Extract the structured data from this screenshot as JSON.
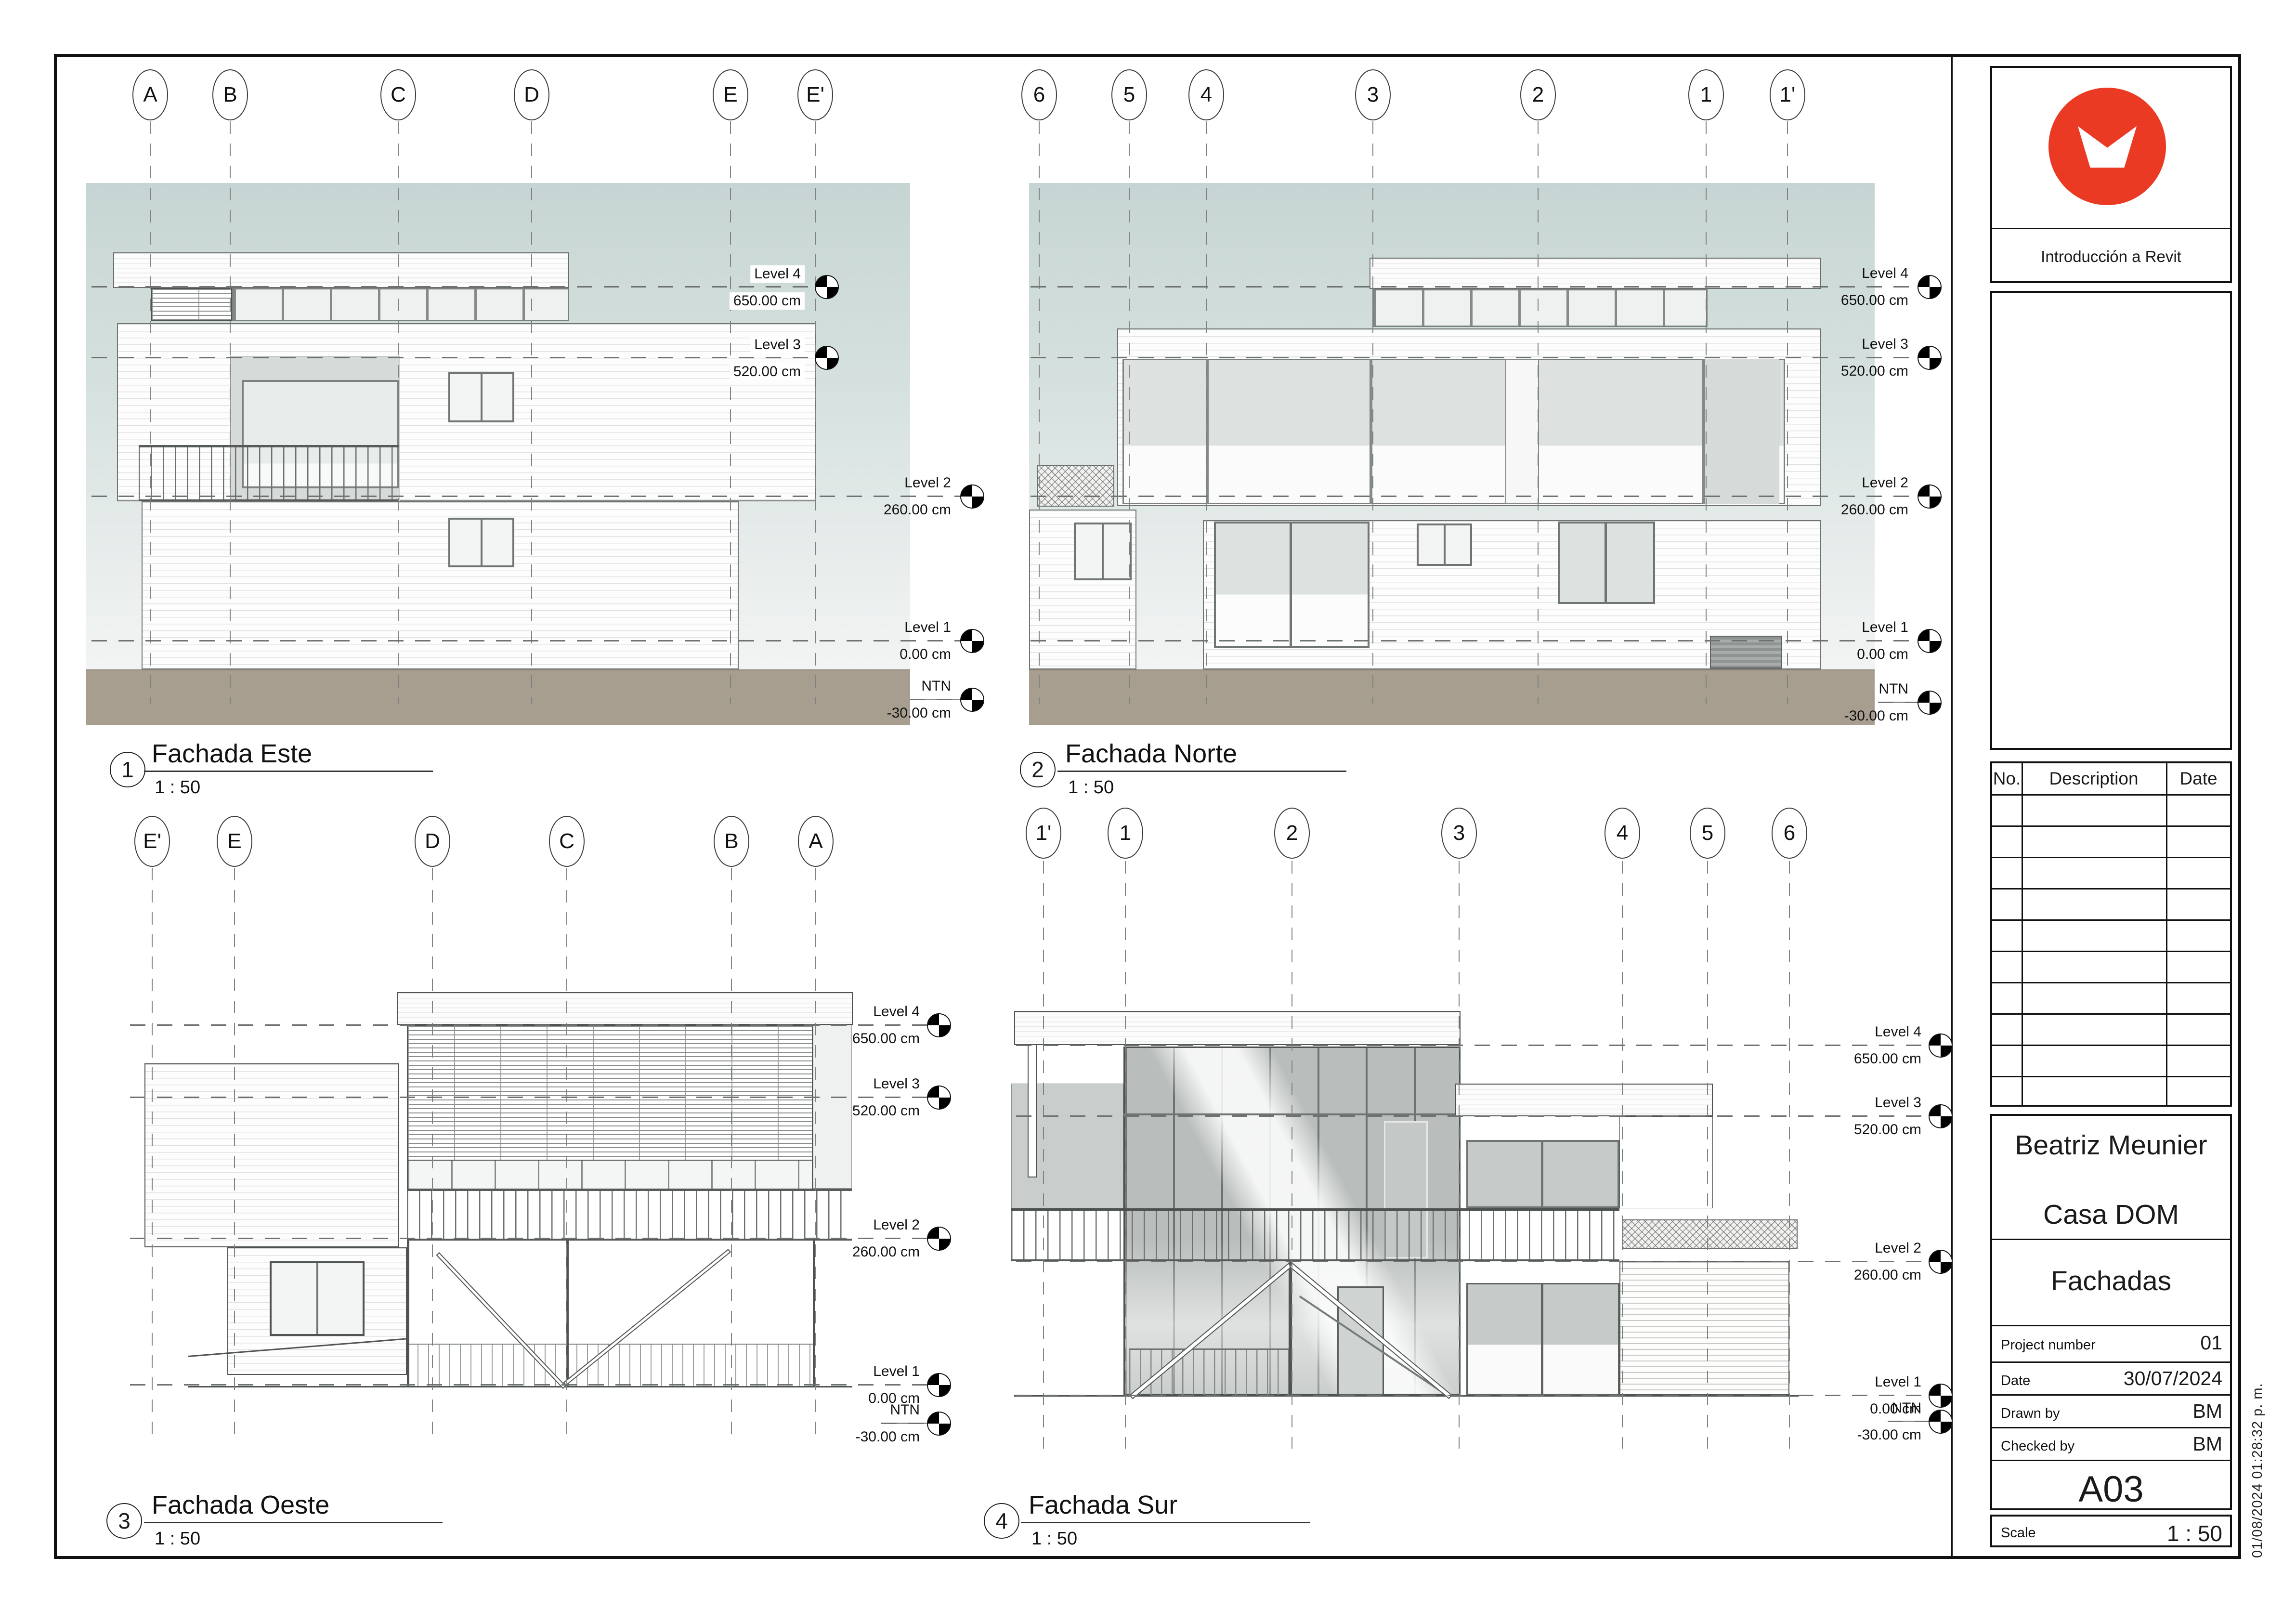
{
  "sheet": {
    "timestamp": "01/08/2024 01:28:32 p. m."
  },
  "logo": {
    "color": "#ea3a23",
    "course": "Introducción a Revit"
  },
  "revision_table": {
    "no": "No.",
    "description": "Description",
    "date": "Date",
    "empty_rows": 10
  },
  "titleblock": {
    "owner": "Beatriz Meunier",
    "project": "Casa DOM",
    "sheet_name": "Fachadas",
    "fields": [
      {
        "label": "Project number",
        "value": "01"
      },
      {
        "label": "Date",
        "value": "30/07/2024"
      },
      {
        "label": "Drawn by",
        "value": "BM"
      },
      {
        "label": "Checked by",
        "value": "BM"
      }
    ],
    "sheet_number": "A03",
    "scale_label": "Scale",
    "scale_value": "1 : 50"
  },
  "views": [
    {
      "number": "1",
      "title": "Fachada Este",
      "scale": "1 : 50",
      "grids": [
        "A",
        "B",
        "C",
        "D",
        "E",
        "E'"
      ],
      "levels": [
        {
          "name": "Level 4",
          "value": "650.00 cm"
        },
        {
          "name": "Level 3",
          "value": "520.00 cm"
        },
        {
          "name": "Level 2",
          "value": "260.00 cm"
        },
        {
          "name": "Level 1",
          "value": "0.00 cm"
        },
        {
          "name": "NTN",
          "value": "-30.00 cm"
        }
      ]
    },
    {
      "number": "2",
      "title": "Fachada Norte",
      "scale": "1 : 50",
      "grids": [
        "6",
        "5",
        "4",
        "3",
        "2",
        "1",
        "1'"
      ],
      "levels": [
        {
          "name": "Level 4",
          "value": "650.00 cm"
        },
        {
          "name": "Level 3",
          "value": "520.00 cm"
        },
        {
          "name": "Level 2",
          "value": "260.00 cm"
        },
        {
          "name": "Level 1",
          "value": "0.00 cm"
        },
        {
          "name": "NTN",
          "value": "-30.00 cm"
        }
      ]
    },
    {
      "number": "3",
      "title": "Fachada Oeste",
      "scale": "1 : 50",
      "grids": [
        "E'",
        "E",
        "D",
        "C",
        "B",
        "A"
      ],
      "levels": [
        {
          "name": "Level 4",
          "value": "650.00 cm"
        },
        {
          "name": "Level 3",
          "value": "520.00 cm"
        },
        {
          "name": "Level 2",
          "value": "260.00 cm"
        },
        {
          "name": "Level 1",
          "value": "0.00 cm"
        },
        {
          "name": "NTN",
          "value": "-30.00 cm"
        }
      ]
    },
    {
      "number": "4",
      "title": "Fachada Sur",
      "scale": "1 : 50",
      "grids": [
        "1'",
        "1",
        "2",
        "3",
        "4",
        "5",
        "6"
      ],
      "levels": [
        {
          "name": "Level 4",
          "value": "650.00 cm"
        },
        {
          "name": "Level 3",
          "value": "520.00 cm"
        },
        {
          "name": "Level 2",
          "value": "260.00 cm"
        },
        {
          "name": "Level 1",
          "value": "0.00 cm"
        },
        {
          "name": "NTN",
          "value": "-30.00 cm"
        }
      ]
    }
  ]
}
